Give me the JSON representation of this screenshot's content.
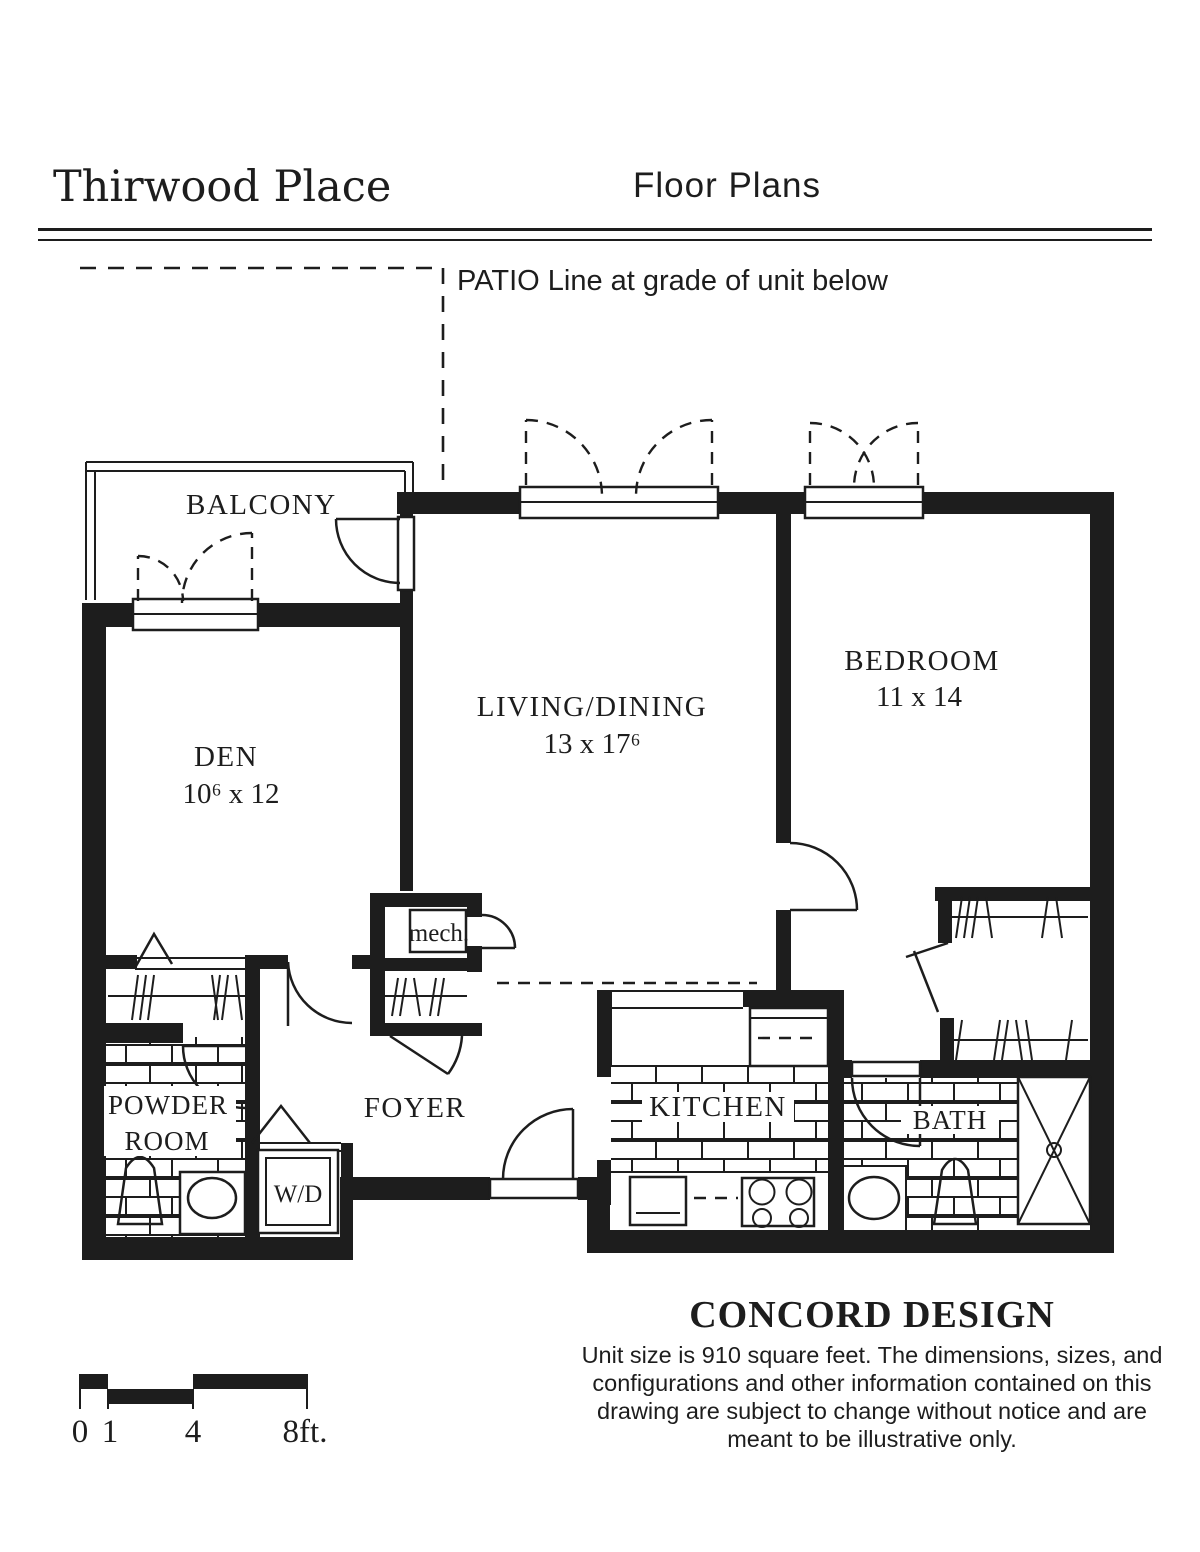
{
  "header": {
    "title": "Thirwood Place",
    "subtitle": "Floor Plans"
  },
  "annotations": {
    "patio_note": "PATIO Line at grade of unit below"
  },
  "rooms": {
    "balcony": {
      "label": "BALCONY"
    },
    "den": {
      "label": "DEN",
      "dims": "10⁶ x 12"
    },
    "living_dining": {
      "label": "LIVING/DINING",
      "dims": "13 x 17⁶"
    },
    "bedroom": {
      "label": "BEDROOM",
      "dims": "11 x 14"
    },
    "powder_room": {
      "label1": "POWDER",
      "label2": "ROOM"
    },
    "foyer": {
      "label": "FOYER"
    },
    "mech": {
      "label": "mech."
    },
    "kitchen": {
      "label": "KITCHEN"
    },
    "bath": {
      "label": "BATH"
    },
    "laundry": {
      "label": "W/D"
    }
  },
  "design": {
    "name": "CONCORD DESIGN",
    "description_lines": [
      "Unit size is 910 square feet. The dimensions, sizes, and",
      "configurations and other information contained on this",
      "drawing are subject to change without notice and are",
      "meant to be illustrative only."
    ]
  },
  "scale_bar": {
    "labels": [
      "0",
      "1",
      "4",
      "8ft."
    ]
  },
  "colors": {
    "ink": "#1d1d1d",
    "paper": "#ffffff"
  }
}
